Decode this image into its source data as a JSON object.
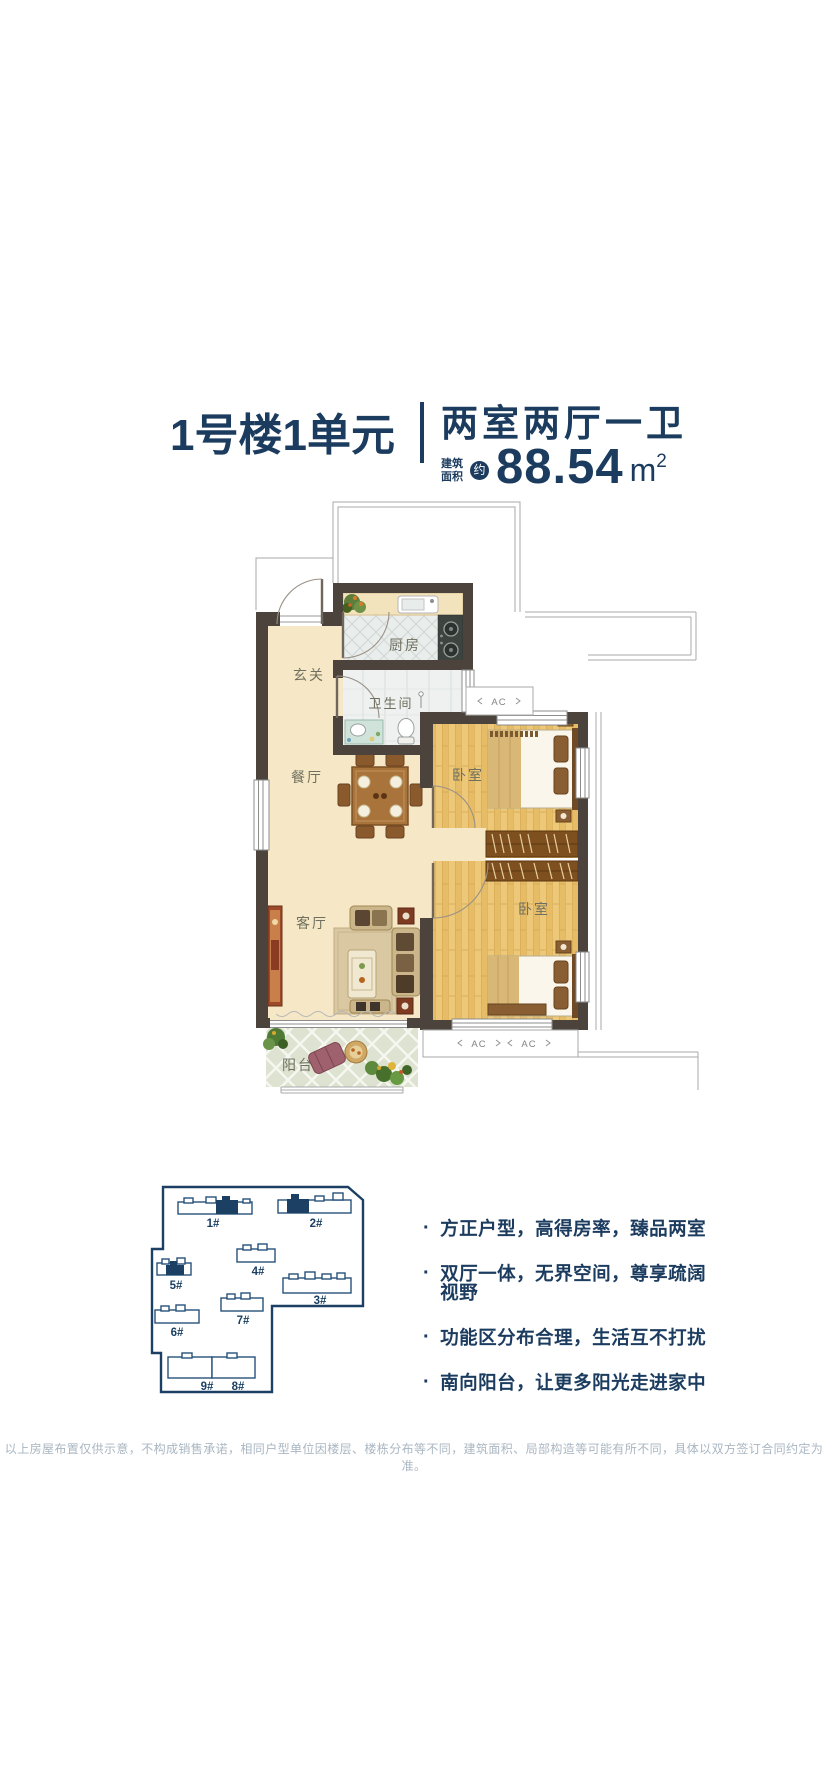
{
  "header": {
    "unit_title": "1号楼1单元",
    "layout_type": "两室两厅一卫",
    "area_label_top": "建筑",
    "area_label_bottom": "面积",
    "area_circa": "约",
    "area_value": "88.54",
    "area_unit": "m",
    "area_unit_exp": "2"
  },
  "floorplan": {
    "rooms": [
      {
        "label": "玄关"
      },
      {
        "label": "厨房"
      },
      {
        "label": "卫生间"
      },
      {
        "label": "餐厅"
      },
      {
        "label": "卧室"
      },
      {
        "label": "客厅"
      },
      {
        "label": "卧室"
      },
      {
        "label": "阳台"
      }
    ],
    "ac_units": [
      {
        "label": "AC"
      },
      {
        "label": "AC"
      },
      {
        "label": "AC"
      }
    ]
  },
  "siteplan": {
    "buildings": [
      {
        "id": "1#",
        "highlighted": true
      },
      {
        "id": "2#",
        "highlighted": true
      },
      {
        "id": "4#",
        "highlighted": false
      },
      {
        "id": "5#",
        "highlighted": true
      },
      {
        "id": "3#",
        "highlighted": false
      },
      {
        "id": "7#",
        "highlighted": false
      },
      {
        "id": "6#",
        "highlighted": false
      },
      {
        "id": "9#",
        "highlighted": false
      },
      {
        "id": "8#",
        "highlighted": false
      }
    ]
  },
  "features": [
    {
      "text": "方正户型，高得房率，臻品两室"
    },
    {
      "text": "双厅一体，无界空间，尊享疏阔视野"
    },
    {
      "text": "功能区分布合理，生活互不打扰"
    },
    {
      "text": "南向阳台，让更多阳光走进家中"
    }
  ],
  "glyphs": {
    "bullet": "·"
  },
  "footer": {
    "disclaimer": "以上房屋布置仅供示意，不构成销售承诺，相同户型单位因楼层、楼栋分布等不同，建筑面积、局部构造等可能有所不同，具体以双方签订合同约定为准。"
  },
  "colors": {
    "navy": "#1c3c5f",
    "wall": "#4b433c",
    "cream_floor": "#f6e8c6",
    "wood_floor": "#ecc878",
    "tile": "#e9edec",
    "balcony_tile": "#dde3d0",
    "muted_text": "#a9b6c2",
    "room_label": "#6f6f5f"
  }
}
